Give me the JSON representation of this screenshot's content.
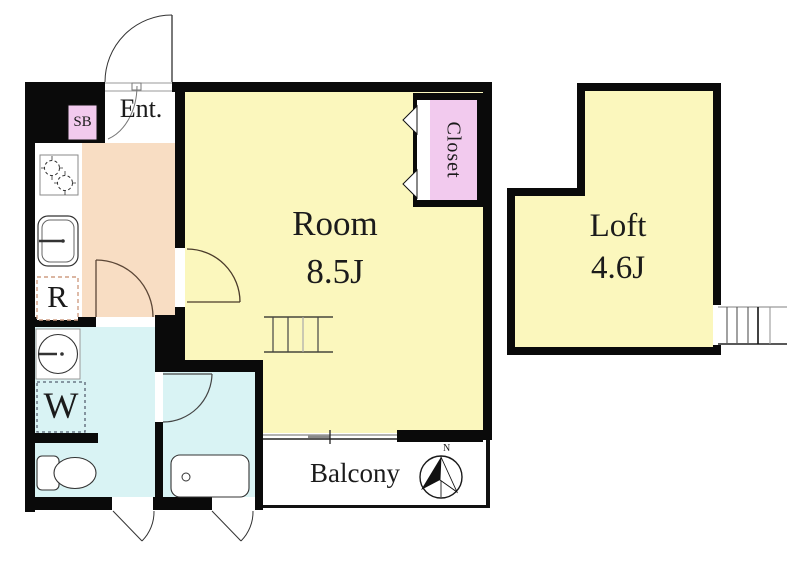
{
  "title": "Apartment floor plan",
  "labels": {
    "entrance": "Ent.",
    "shoe_box": "SB",
    "room_name": "Room",
    "room_size": "8.5J",
    "loft_name": "Loft",
    "loft_size": "4.6J",
    "closet": "Closet",
    "refrigerator": "R",
    "washer": "W",
    "balcony": "Balcony",
    "compass_north": "N"
  },
  "colors": {
    "room_fill": "#FBF7BD",
    "kitchen_fill": "#F8DDC3",
    "bath_fill": "#D9F3F4",
    "closet_fill": "#F2CAEE",
    "wall": "#0A0A0A",
    "line": "#333333"
  }
}
